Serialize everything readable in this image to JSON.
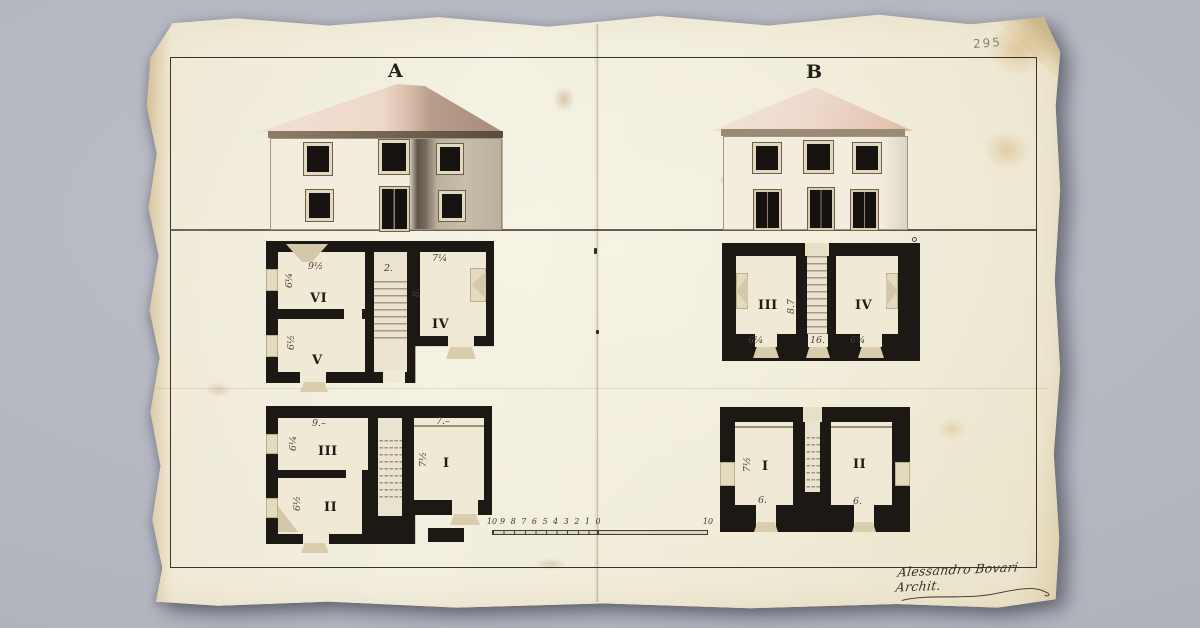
{
  "sheet": {
    "folio_number": "295",
    "signature": "Alessandro Bovari Archit.",
    "scale_bar": {
      "ticks": [
        "10",
        "9",
        "8",
        "7",
        "6",
        "5",
        "4",
        "3",
        "2",
        "1",
        "0"
      ],
      "right_end_label": "10"
    }
  },
  "elevations": {
    "a": {
      "label": "A"
    },
    "b": {
      "label": "B"
    }
  },
  "plans": {
    "a_upper": {
      "room_vi": "VI",
      "room_v": "V",
      "room_iv": "IV",
      "dim_top_left": "9½",
      "dim_stair_top": "2.",
      "dim_top_right": "7¼",
      "dim_vi_left": "6¼",
      "dim_v_left": "6½",
      "dim_stair_right": "8."
    },
    "b_upper": {
      "room_iii": "III",
      "room_iv": "IV",
      "dim_bottom_left": "6¼",
      "dim_bottom_center": "16.",
      "dim_bottom_right": "6¼",
      "dim_stair_left": "8.7"
    },
    "a_lower": {
      "room_iii": "III",
      "room_ii": "II",
      "room_i": "I",
      "dim_top_left": "9.–",
      "dim_top_right": "7.–",
      "dim_iii_left": "6¼",
      "dim_ii_left": "6½",
      "dim_i_left": "7½"
    },
    "b_lower": {
      "room_i": "I",
      "room_ii": "II",
      "dim_i_bottom": "6.",
      "dim_ii_bottom": "6.",
      "dim_i_left": "7½"
    }
  },
  "palette": {
    "background_gray": "#b3b5bf",
    "paper_cream": "#f1ecd8",
    "ink": "#39332b",
    "plan_wall_black": "#1c1814",
    "roof_pink": "#eed9cc",
    "shadow_brown": "#9d8c77"
  }
}
